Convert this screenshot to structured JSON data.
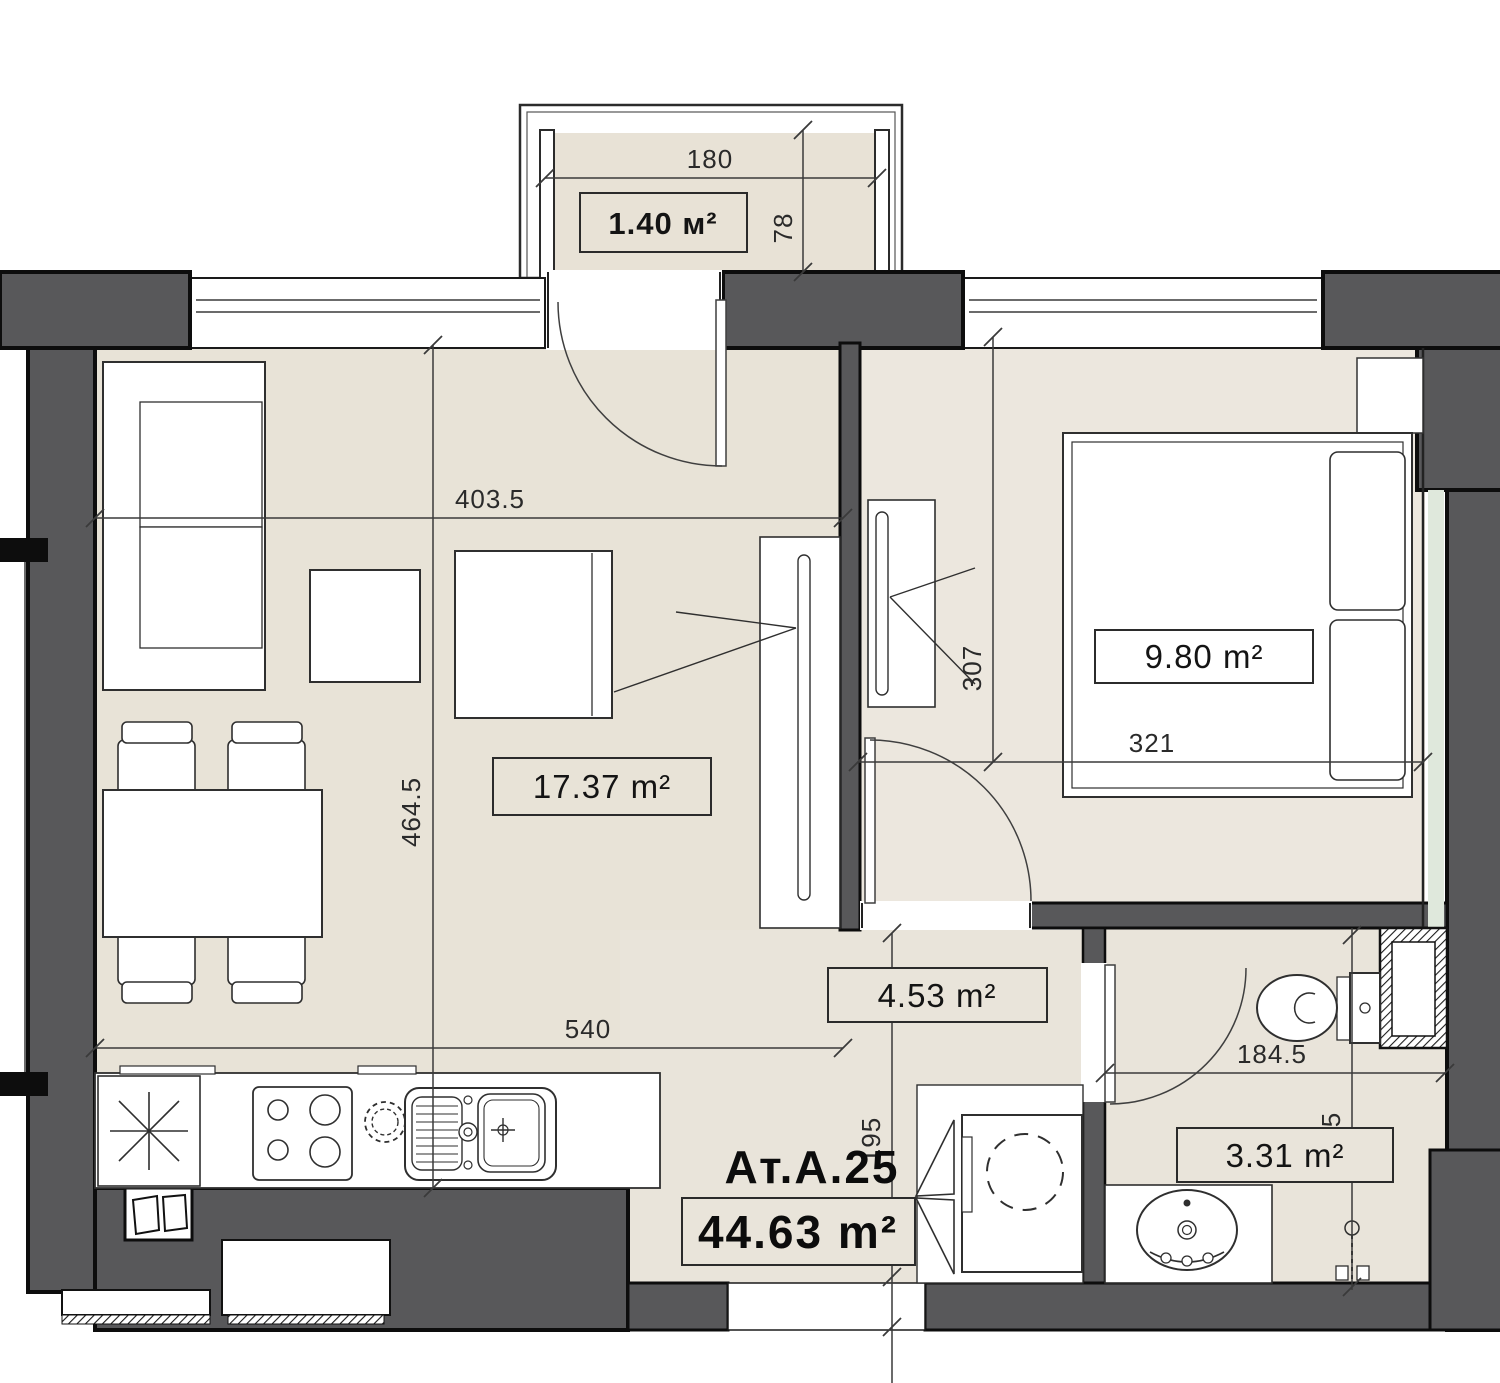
{
  "plan": {
    "id_label": "Ат.А.25",
    "total_area": "44.63 m²",
    "rooms": {
      "balcony": {
        "area": "1.40 м²"
      },
      "living": {
        "area": "17.37 m²"
      },
      "bedroom": {
        "area": "9.80 m²"
      },
      "hall": {
        "area": "4.53 m²"
      },
      "bathroom": {
        "area": "3.31 m²"
      }
    },
    "dimensions": {
      "balcony_width": "180",
      "balcony_depth": "78",
      "living_width": "403.5",
      "living_depth": "464.5",
      "living_full_width": "540",
      "bedroom_width": "321",
      "bedroom_depth": "307",
      "hall_depth": "195",
      "bathroom_width": "184.5",
      "bathroom_depth": "195"
    },
    "colors": {
      "wall": "#58585a",
      "outline": "#0d0d0d",
      "floor": "#e8e3d7",
      "floor_warm": "#ece7de",
      "accent_green": "#dfe8dc"
    }
  }
}
